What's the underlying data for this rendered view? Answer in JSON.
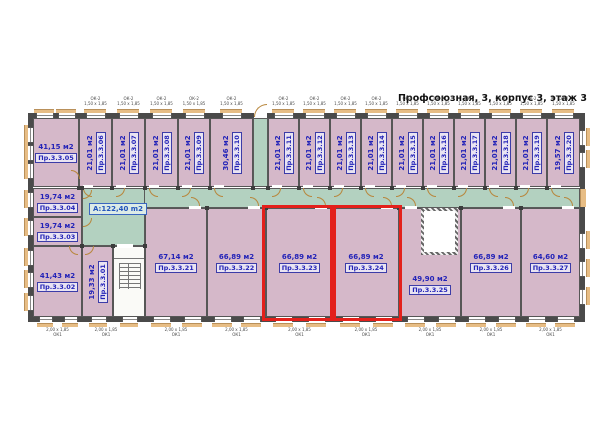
{
  "title": "Профсоюзная, 3, корпус 3, этаж 3",
  "corridor_label": "A:122,40 m2",
  "rooms": {
    "r01": {
      "area": "19,33 м2",
      "label": "Пр.3.3.01"
    },
    "r02": {
      "area": "41,43 м2",
      "label": "Пр.3.3.02"
    },
    "r03": {
      "area": "19,74 м2",
      "label": "Пр.3.3.03"
    },
    "r04": {
      "area": "19,74 м2",
      "label": "Пр.3.3.04"
    },
    "r05": {
      "area": "41,15 м2",
      "label": "Пр.3.3.05"
    },
    "r06": {
      "area": "21,01 м2",
      "label": "Пр.3.3.06"
    },
    "r07": {
      "area": "21,01 м2",
      "label": "Пр.3.3.07"
    },
    "r08": {
      "area": "21,01 м2",
      "label": "Пр.3.3.08"
    },
    "r09": {
      "area": "21,01 м2",
      "label": "Пр.3.3.09"
    },
    "r10": {
      "area": "30,46 м2",
      "label": "Пр.3.3.10"
    },
    "r11": {
      "area": "21,01 м2",
      "label": "Пр.3.3.11"
    },
    "r12": {
      "area": "21,01 м2",
      "label": "Пр.3.3.12"
    },
    "r13": {
      "area": "21,01 м2",
      "label": "Пр.3.3.13"
    },
    "r14": {
      "area": "21,01 м2",
      "label": "Пр.3.3.14"
    },
    "r15": {
      "area": "21,01 м2",
      "label": "Пр.3.3.15"
    },
    "r16": {
      "area": "21,01 м2",
      "label": "Пр.3.3.16"
    },
    "r17": {
      "area": "21,01 м2",
      "label": "Пр.3.3.17"
    },
    "r18": {
      "area": "21,01 м2",
      "label": "Пр.3.3.18"
    },
    "r19": {
      "area": "21,01 м2",
      "label": "Пр.3.3.19"
    },
    "r20": {
      "area": "19,57 м2",
      "label": "Пр.3.3.20"
    },
    "r21": {
      "area": "67,14 м2",
      "label": "Пр.3.3.21"
    },
    "r22": {
      "area": "66,89 м2",
      "label": "Пр.3.3.22"
    },
    "r23": {
      "area": "66,89 м2",
      "label": "Пр.3.3.23"
    },
    "r24": {
      "area": "66,89 м2",
      "label": "Пр.3.3.24"
    },
    "r25": {
      "area": "49,90 м2",
      "label": "Пр.3.3.25"
    },
    "r26": {
      "area": "66,89 м2",
      "label": "Пр.3.3.26"
    },
    "r27": {
      "area": "64,60 м2",
      "label": "Пр.3.3.27"
    }
  },
  "highlighted_rooms": [
    "Пр.3.3.23",
    "Пр.3.3.24"
  ],
  "window_marks": {
    "top_line1": "ОК-2",
    "top_line2": "1,50 х 1,85",
    "bottom_line1": "2,00 х 1,85",
    "bottom_line2": "ОК1",
    "side": "1,50 х 1,85"
  },
  "colors": {
    "room_fill": "#d5b8c9",
    "corridor_fill": "#b3d1c0",
    "highlight": "#e3201b",
    "wall": "#4a4a4a",
    "label_text": "#2323b8",
    "door_arc": "#b8863b",
    "window_sill": "#e7bd85"
  }
}
